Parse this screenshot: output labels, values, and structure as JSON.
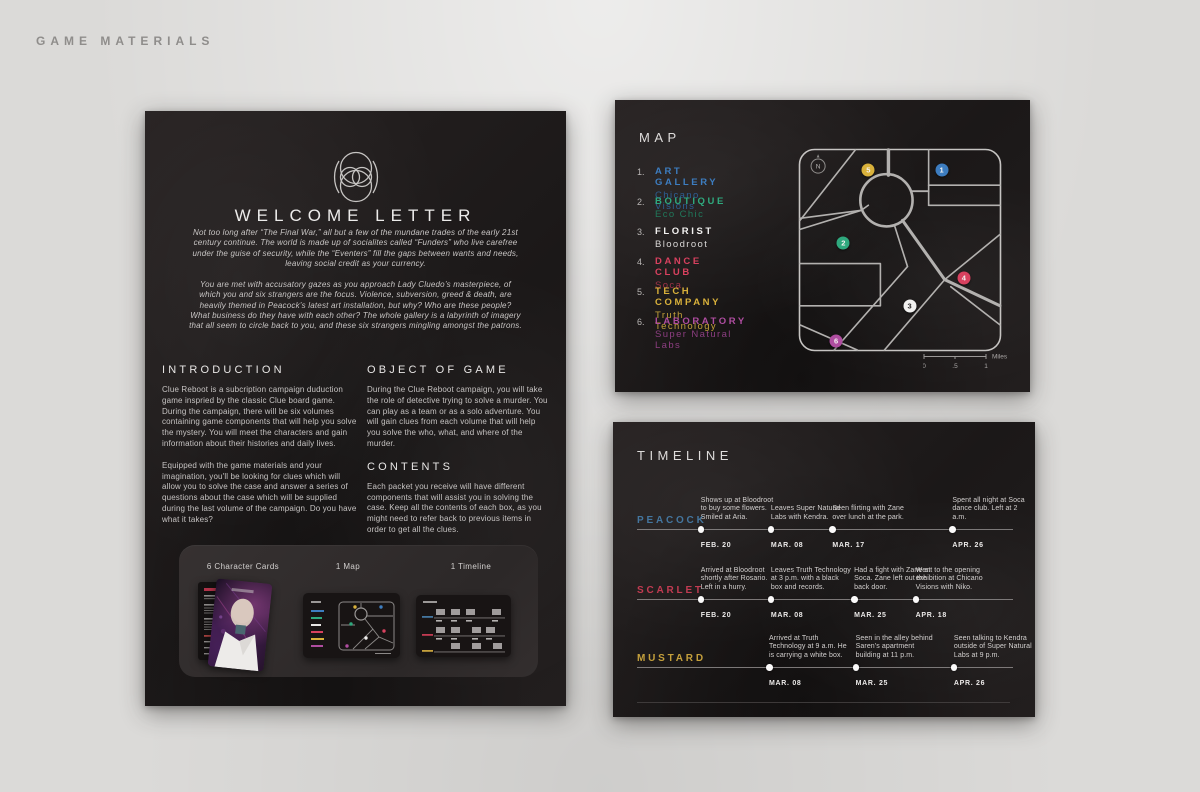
{
  "page": {
    "label": "GAME MATERIALS"
  },
  "letter": {
    "title": "WELCOME LETTER",
    "intro": [
      "Not too long after “The Final War,” all but a few of the mundane trades of the early 21st century continue. The world is made up of socialites called “Funders” who live carefree under the guise of security, while the “Eventers” fill the gaps between wants and needs, leaving social credit as your currency.",
      "You are met with accusatory gazes as you approach Lady Cluedo’s masterpiece, of which you and six strangers are the focus. Violence, subversion, greed & death, are heavily themed in Peacock’s latest art installation, but why? Who are these people? What business do they have with each other? The whole gallery is a labyrinth of imagery that all seem to circle back to you, and these six strangers mingling amongst the patrons."
    ],
    "sections": {
      "introduction": {
        "heading": "INTRODUCTION",
        "p1": "Clue Reboot is a subcription campaign duduction game inspried by the classic Clue board game. During the campaign, there will be six volumes containing game components that will help you solve the mystery.  You will meet the characters and gain information about their histories and daily lives.",
        "p2": "Equipped with the game materials and your imagination, you'll be looking for clues which will allow you to solve the case and answer a series of questions about the case which will be supplied during the last volume of the campaign. Do you have what it takes?"
      },
      "object": {
        "heading": "OBJECT OF GAME",
        "p1": "During the Clue Reboot campaign,  you will take the role of detective trying to solve a murder. You can play as a team or as a solo adventure. You will gain clues from each volume that will help you solve the who, what, and where of the murder."
      },
      "contents": {
        "heading": "CONTENTS",
        "p1": "Each packet you receive will have different components that will assist you in solving the case.  Keep all the contents of each box, as you might need to refer back to previous items in order to get all the clues."
      }
    },
    "tray": {
      "labels": [
        "6 Character Cards",
        "1 Map",
        "1 Timeline"
      ]
    }
  },
  "map": {
    "title": "MAP",
    "compass": "N",
    "legend": [
      {
        "num": "1.",
        "type": "ART GALLERY",
        "name": "Chicano Visions",
        "color": "#3D7DC0",
        "subcolor": "#2C5F95"
      },
      {
        "num": "2.",
        "type": "BOUTIQUE",
        "name": "Eco Chic",
        "color": "#2FA97E",
        "subcolor": "#20795B"
      },
      {
        "num": "3.",
        "type": "FLORIST",
        "name": "Bloodroot",
        "color": "#F2F1F0",
        "subcolor": "#DAD8D7"
      },
      {
        "num": "4.",
        "type": "DANCE CLUB",
        "name": "Soca",
        "color": "#D8415F",
        "subcolor": "#A23349"
      },
      {
        "num": "5.",
        "type": "TECH COMPANY",
        "name": "Truth Technology",
        "color": "#D9B13B",
        "subcolor": "#C3A039"
      },
      {
        "num": "6.",
        "type": "LABORATORY",
        "name": "Super Natural Labs",
        "color": "#AF4DA0",
        "subcolor": "#8C3E81"
      }
    ],
    "markers": [
      {
        "label": "1",
        "color": "#3D7DC0",
        "x": "70.4%",
        "y": "10.8%"
      },
      {
        "label": "2",
        "color": "#2FA97E",
        "x": "22.2%",
        "y": "46.8%"
      },
      {
        "label": "3",
        "color": "#F2F1F0",
        "x": "54.7%",
        "y": "77.3%"
      },
      {
        "label": "4",
        "color": "#D8415F",
        "x": "81.3%",
        "y": "63.5%"
      },
      {
        "label": "5",
        "color": "#D9B13B",
        "x": "34.5%",
        "y": "10.8%"
      },
      {
        "label": "6",
        "color": "#AF4DA0",
        "x": "18.7%",
        "y": "94.6%"
      }
    ],
    "scale": {
      "ticks": [
        "0",
        ".5",
        "1"
      ],
      "unit": "Miles"
    }
  },
  "timeline": {
    "title": "TIMELINE",
    "rows": [
      {
        "name": "PEACOCK",
        "color": "#44769F",
        "events": [
          {
            "date": "FEB. 20",
            "text": "Shows up at Bloodroot to buy some flowers. Smiled at Aria.",
            "x": "17%"
          },
          {
            "date": "MAR. 08",
            "text": "Leaves Super Natural Labs with Kendra.",
            "x": "35.7%"
          },
          {
            "date": "MAR. 17",
            "text": "Seen flirting with Zane over lunch at the park.",
            "x": "52.1%"
          },
          {
            "date": "APR. 26",
            "text": "Spent all night at Soca dance club. Left at 2 a.m.",
            "x": "84.1%"
          }
        ]
      },
      {
        "name": "SCARLET",
        "color": "#C23B52",
        "events": [
          {
            "date": "FEB. 20",
            "text": "Arrived at Bloodroot shortly after Rosario. Left in a hurry.",
            "x": "17%"
          },
          {
            "date": "MAR. 08",
            "text": "Leaves Truth Technology at 3 p.m. with a black box and records.",
            "x": "35.7%"
          },
          {
            "date": "MAR. 25",
            "text": "Had a fight with Zane at Soca. Zane left out the back door.",
            "x": "57.9%"
          },
          {
            "date": "APR. 18",
            "text": "Went to the opening exhibition at Chicano Visions with Niko.",
            "x": "74.3%"
          }
        ]
      },
      {
        "name": "MUSTARD",
        "color": "#C5A03C",
        "events": [
          {
            "date": "MAR. 08",
            "text": "Arrived at Truth Technology at 9 a.m.  He is carrying a white box.",
            "x": "35.2%"
          },
          {
            "date": "MAR. 25",
            "text": "Seen in the alley behind Saren's apartment building at 11 p.m.",
            "x": "58.3%"
          },
          {
            "date": "APR. 26",
            "text": "Seen talking to Kendra outside of Super Natural Labs at 9 p.m.",
            "x": "84.5%"
          }
        ]
      }
    ]
  }
}
